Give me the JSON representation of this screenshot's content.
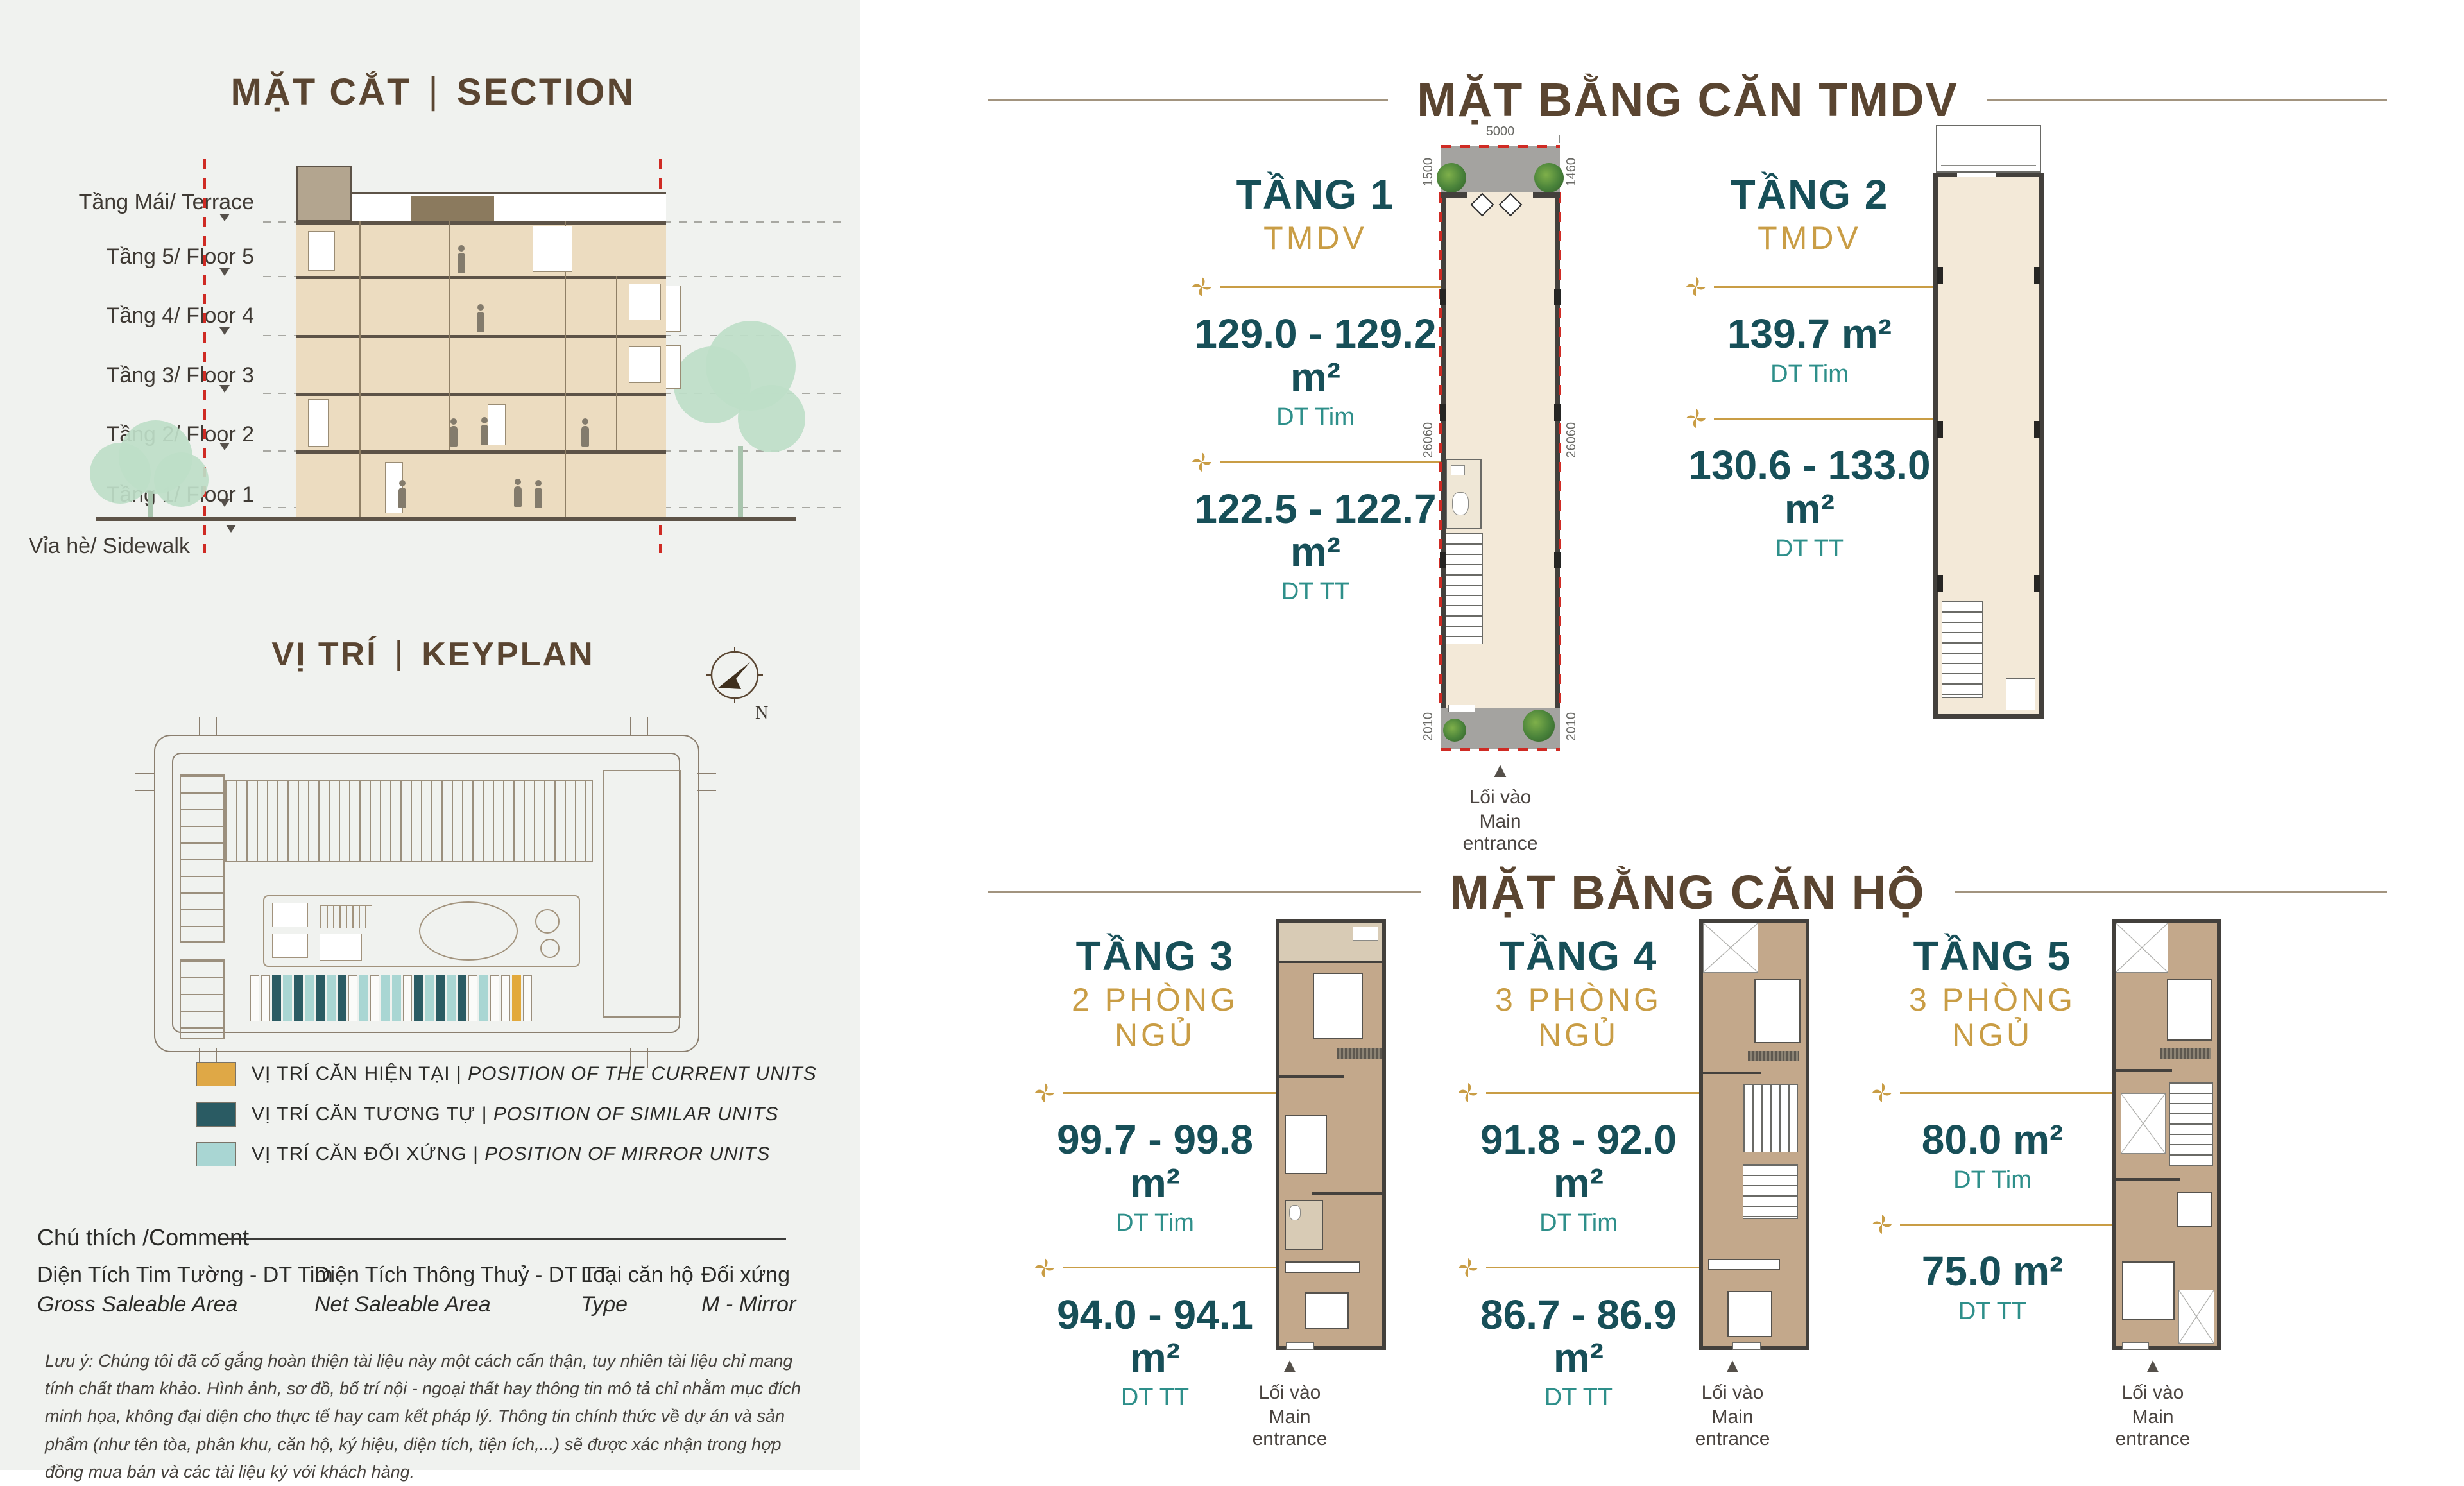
{
  "misc": {
    "pipe": "|"
  },
  "colors": {
    "accent_gold": "#C99D45",
    "teal_dark": "#174f58",
    "teal_label": "#2e8f8a",
    "brown_heading": "#5a4531",
    "red_boundary": "#cf2b24"
  },
  "section": {
    "title_vi": "MẶT CẮT",
    "title_en": "SECTION",
    "floors": [
      "Tầng Mái/ Terrace",
      "Tầng 5/ Floor 5",
      "Tầng 4/ Floor 4",
      "Tầng 3/ Floor 3",
      "Tầng 2/ Floor 2",
      "Tầng 1/ Floor 1",
      "Vỉa hè/ Sidewalk"
    ]
  },
  "keyplan": {
    "title_vi": "VỊ TRÍ",
    "title_en": "KEYPLAN",
    "north": "N",
    "legend": [
      {
        "color": "#DFA846",
        "vi": "VỊ TRÍ CĂN HIỆN TẠI",
        "en": "POSITION OF THE CURRENT UNITS"
      },
      {
        "color": "#2A5B63",
        "vi": "VỊ TRÍ CĂN TƯƠNG TỰ",
        "en": "POSITION OF SIMILAR UNITS"
      },
      {
        "color": "#A9D6D3",
        "vi": "VỊ TRÍ CĂN ĐỐI XỨNG",
        "en": "POSITION OF MIRROR UNITS"
      }
    ],
    "strip_palette": {
      "W": "#fbfbf9",
      "D": "#2A5B63",
      "L": "#A9D6D3",
      "Y": "#E2A93C"
    },
    "strips": [
      "W",
      "W",
      "D",
      "L",
      "D",
      "L",
      "D",
      "L",
      "D",
      "W",
      "L",
      "W",
      "L",
      "L",
      "W",
      "D",
      "L",
      "D",
      "L",
      "D",
      "W",
      "L",
      "W",
      "W",
      "Y",
      "W"
    ]
  },
  "comment": {
    "title": "Chú thích /Comment",
    "terms": [
      {
        "vi": "Diện Tích Tim Tường - DT Tim",
        "en": "Gross Saleable Area"
      },
      {
        "vi": "Diện Tích Thông Thuỷ - DT TT",
        "en": "Net Saleable Area"
      },
      {
        "vi": "Loại căn hộ",
        "en": "Type"
      },
      {
        "vi": "Đối xứng",
        "en": "M - Mirror"
      }
    ],
    "note": "Lưu ý: Chúng tôi đã cố gắng hoàn thiện tài liệu này một cách cẩn thận, tuy nhiên tài liệu chỉ mang tính chất tham khảo. Hình ảnh, sơ đồ, bố trí nội - ngoại thất hay thông tin mô tả chỉ nhằm mục đích minh họa, không đại diện cho thực tế hay cam kết pháp lý. Thông tin chính thức về dự án và sản phẩm (như tên tòa, phân khu, căn hộ, ký hiệu, diện tích, tiện ích,...) sẽ được xác nhận trong hợp đồng mua bán và các tài liệu ký với khách hàng."
  },
  "tmdv": {
    "heading": "MẶT BẰNG CĂN TMDV",
    "units": [
      {
        "floor": "TẦNG 1",
        "type": "TMDV",
        "gross": "129.0 - 129.2 m²",
        "gross_label": "DT Tim",
        "net": "122.5 - 122.7 m²",
        "net_label": "DT TT",
        "entry_vi": "Lối vào",
        "entry_en": "Main entrance",
        "dim_top": "5000",
        "dim_left": "1500",
        "dim_right": "1460",
        "dim_side": "26060",
        "dim_entry": "2010"
      },
      {
        "floor": "TẦNG 2",
        "type": "TMDV",
        "gross": "139.7 m²",
        "gross_label": "DT Tim",
        "net": "130.6 - 133.0 m²",
        "net_label": "DT TT"
      }
    ]
  },
  "apts": {
    "heading": "MẶT BẰNG CĂN HỘ",
    "units": [
      {
        "floor": "TẦNG 3",
        "type": "2 PHÒNG NGỦ",
        "gross": "99.7 - 99.8 m²",
        "gross_label": "DT Tim",
        "net": "94.0 - 94.1 m²",
        "net_label": "DT TT",
        "entry_vi": "Lối vào",
        "entry_en": "Main entrance"
      },
      {
        "floor": "TẦNG 4",
        "type": "3 PHÒNG NGỦ",
        "gross": "91.8 - 92.0 m²",
        "gross_label": "DT Tim",
        "net": "86.7 - 86.9 m²",
        "net_label": "DT TT",
        "entry_vi": "Lối vào",
        "entry_en": "Main entrance"
      },
      {
        "floor": "TẦNG 5",
        "type": "3 PHÒNG NGỦ",
        "gross": "80.0 m²",
        "gross_label": "DT Tim",
        "net": "75.0 m²",
        "net_label": "DT TT",
        "entry_vi": "Lối vào",
        "entry_en": "Main entrance"
      }
    ]
  }
}
